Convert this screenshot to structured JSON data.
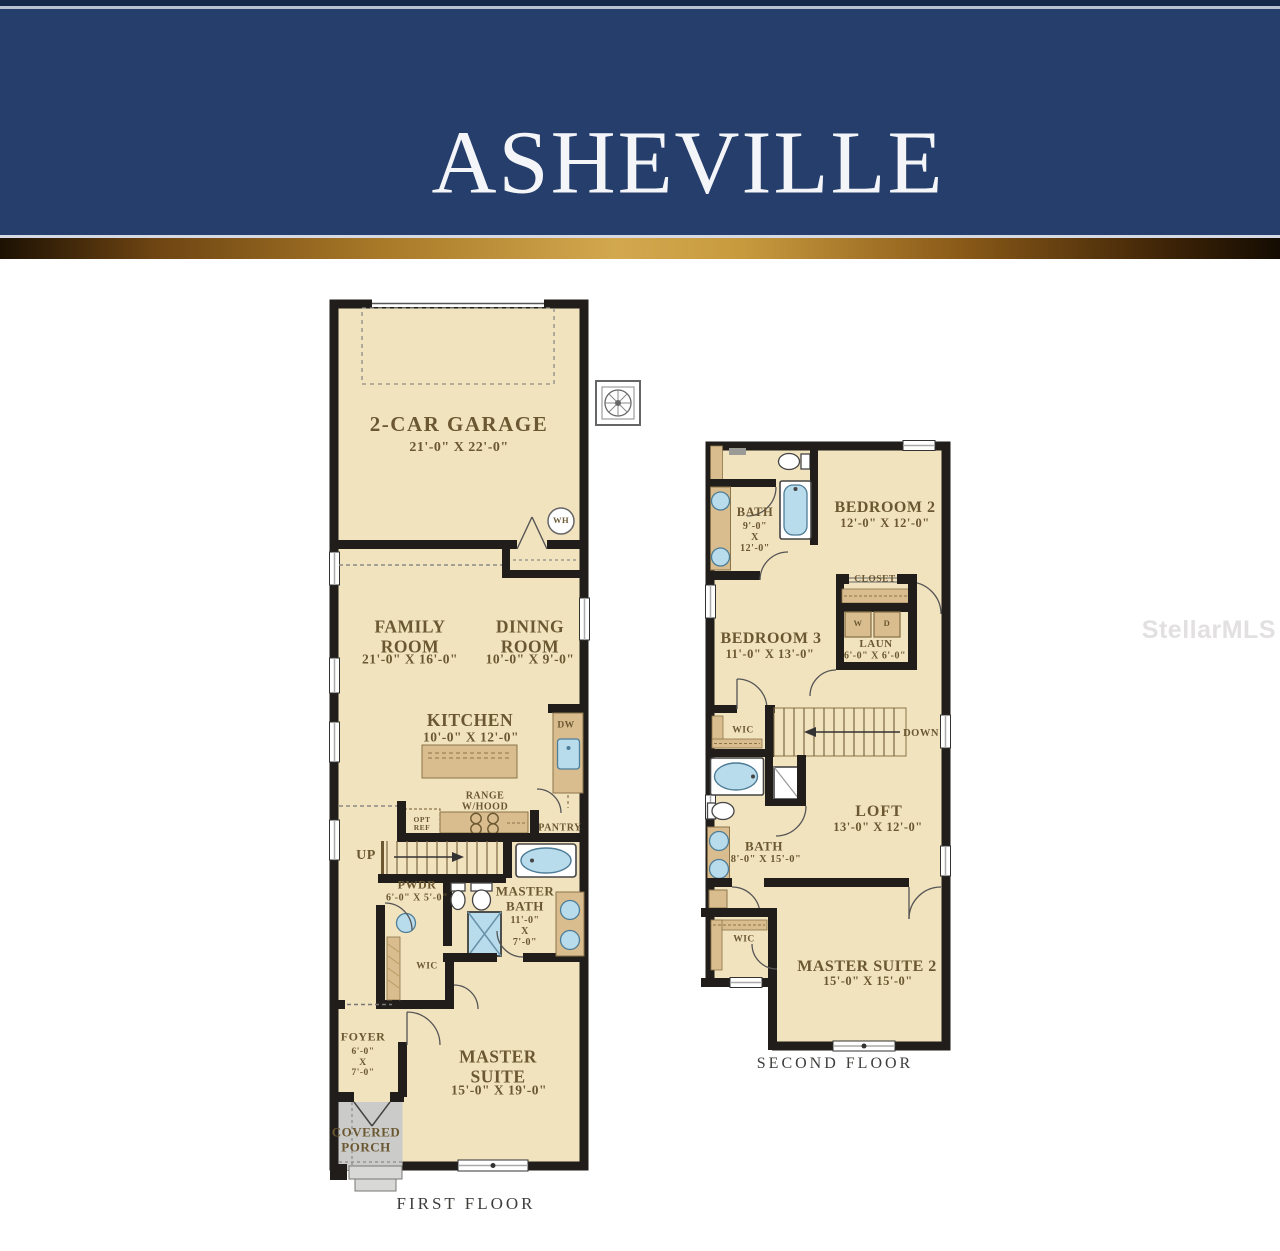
{
  "header": {
    "title": "ASHEVILLE"
  },
  "watermark": "StellarMLS",
  "colors": {
    "navy": "#263e6b",
    "gold": "#c89a3e",
    "floor": "#f2e3bf",
    "wall": "#201d1a",
    "cabinet": "#d9bd8e",
    "porch_gray": "#cbcbc9",
    "fixture_blue": "#b9dcec",
    "label_brown": "#6b5832"
  },
  "first_floor": {
    "caption": "FIRST FLOOR",
    "rooms": {
      "garage": {
        "name": "2-CAR GARAGE",
        "dims": "21'-0\" X 22'-0\""
      },
      "family": {
        "name": "FAMILY\nROOM",
        "dims": "21'-0\" X 16'-0\""
      },
      "dining": {
        "name": "DINING\nROOM",
        "dims": "10'-0\" X 9'-0\""
      },
      "kitchen": {
        "name": "KITCHEN",
        "dims": "10'-0\" X 12'-0\""
      },
      "pwdr": {
        "name": "PWDR",
        "dims": "6'-0\" X 5'-0\""
      },
      "master_bath": {
        "name": "MASTER\nBATH",
        "dims": "11'-0\"\nX\n7'-0\""
      },
      "wic": {
        "name": "WIC"
      },
      "foyer": {
        "name": "FOYER",
        "dims": "6'-0\"\nX\n7'-0\""
      },
      "master_suite": {
        "name": "MASTER\nSUITE",
        "dims": "15'-0\" X 19'-0\""
      },
      "porch": {
        "name": "COVERED\nPORCH"
      }
    },
    "annotations": {
      "wh": "WH",
      "dw": "DW",
      "opt_ref": "OPT\nREF",
      "range": "RANGE\nW/HOOD",
      "pantry": "PANTRY",
      "up": "UP"
    }
  },
  "second_floor": {
    "caption": "SECOND FLOOR",
    "rooms": {
      "bath1": {
        "name": "BATH",
        "dims": "9'-0\"\nX\n12'-0\""
      },
      "bedroom2": {
        "name": "BEDROOM 2",
        "dims": "12'-0\" X 12'-0\""
      },
      "closet": {
        "name": "CLOSET"
      },
      "laundry": {
        "name": "LAUN",
        "dims": "6'-0\" X 6'-0\""
      },
      "bedroom3": {
        "name": "BEDROOM 3",
        "dims": "11'-0\" X 13'-0\""
      },
      "wic_hall": {
        "name": "WIC"
      },
      "loft": {
        "name": "LOFT",
        "dims": "13'-0\" X 12'-0\""
      },
      "bath2": {
        "name": "BATH",
        "dims": "8'-0\" X 15'-0\""
      },
      "wic_master": {
        "name": "WIC"
      },
      "master_suite2": {
        "name": "MASTER SUITE 2",
        "dims": "15'-0\" X 15'-0\""
      }
    },
    "annotations": {
      "down": "DOWN",
      "washer": "W",
      "dryer": "D"
    }
  }
}
